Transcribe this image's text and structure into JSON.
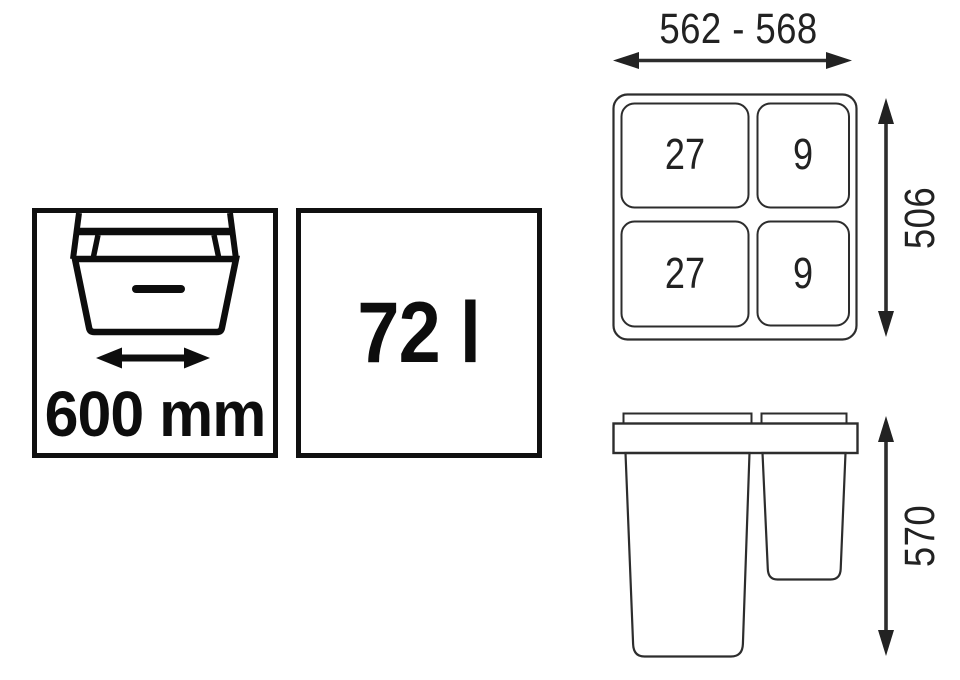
{
  "page": {
    "background": "#ffffff"
  },
  "colors": {
    "thin_line": "#2d2d2d",
    "bold_line": "#0d0d0d",
    "text_dim": "#222222"
  },
  "badges": {
    "drawer_width": {
      "value": "600 mm",
      "icon": "open-drawer-icon"
    },
    "capacity": {
      "value": "72 l"
    }
  },
  "top_view": {
    "width_dimension": "562 - 568",
    "height_dimension": "506",
    "compartments": [
      {
        "position": "top-left",
        "volume": "27"
      },
      {
        "position": "top-right",
        "volume": "9"
      },
      {
        "position": "bottom-left",
        "volume": "27"
      },
      {
        "position": "bottom-right",
        "volume": "9"
      }
    ]
  },
  "front_view": {
    "height_dimension": "570"
  }
}
